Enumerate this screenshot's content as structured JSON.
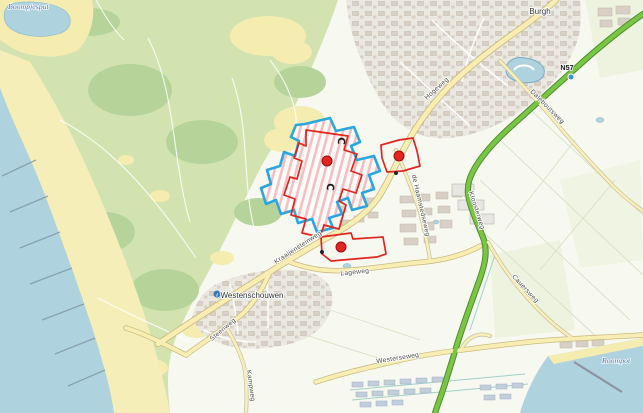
{
  "map": {
    "places": {
      "burgh": "Burgh",
      "westenschouwen": "Westenschouwen"
    },
    "waters": {
      "boompjesput": "Boompjesput",
      "roompot": "Roompot"
    },
    "route_badge": {
      "n57": "N57"
    },
    "roads": {
      "hogeweg": "Hogeweg",
      "kraaijensteinweg": "Kraaijensteinweg",
      "steenweg": "Steenweg",
      "lageweg": "Lageweg",
      "kampweg": "Kampweg",
      "westerseweg": "Westerseweg",
      "daleboutsweg": "Daleboutsweg",
      "kloosterweg": "Kloosterweg",
      "cauersweg": "Cauersweg",
      "haamstedseweg": "de Haamstedseweg"
    },
    "icons": {
      "camping_symbol": "C",
      "info_symbol": "i"
    },
    "overlays": {
      "blue_selection_count": 1,
      "red_selection_count": 3,
      "red_marker_count": 3,
      "camping_icon_count": 2
    },
    "colors": {
      "sea": "#aed2de",
      "sand": "#f5ecb0",
      "dune_green": "#d3e3af",
      "forest_green": "#b6d49a",
      "field": "#f7f9f1",
      "urban": "#ebe8e1",
      "building": "#d8d0c6",
      "road_fill": "#f8edb2",
      "road_casing": "#c9ba7e",
      "n57_green": "#79c544",
      "selection_blue": "#2ba6df",
      "selection_red": "#e3241f",
      "water_label_blue": "#3e74ad"
    }
  }
}
